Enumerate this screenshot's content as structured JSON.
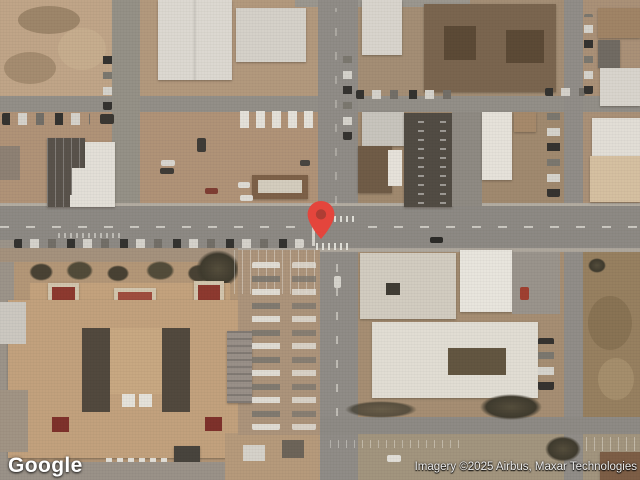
{
  "map": {
    "logo": "Google",
    "attribution": "Imagery ©2025 Airbus, Maxar Technologies",
    "marker": {
      "fill": "#E4453C",
      "dot": "#AD3D34"
    }
  }
}
